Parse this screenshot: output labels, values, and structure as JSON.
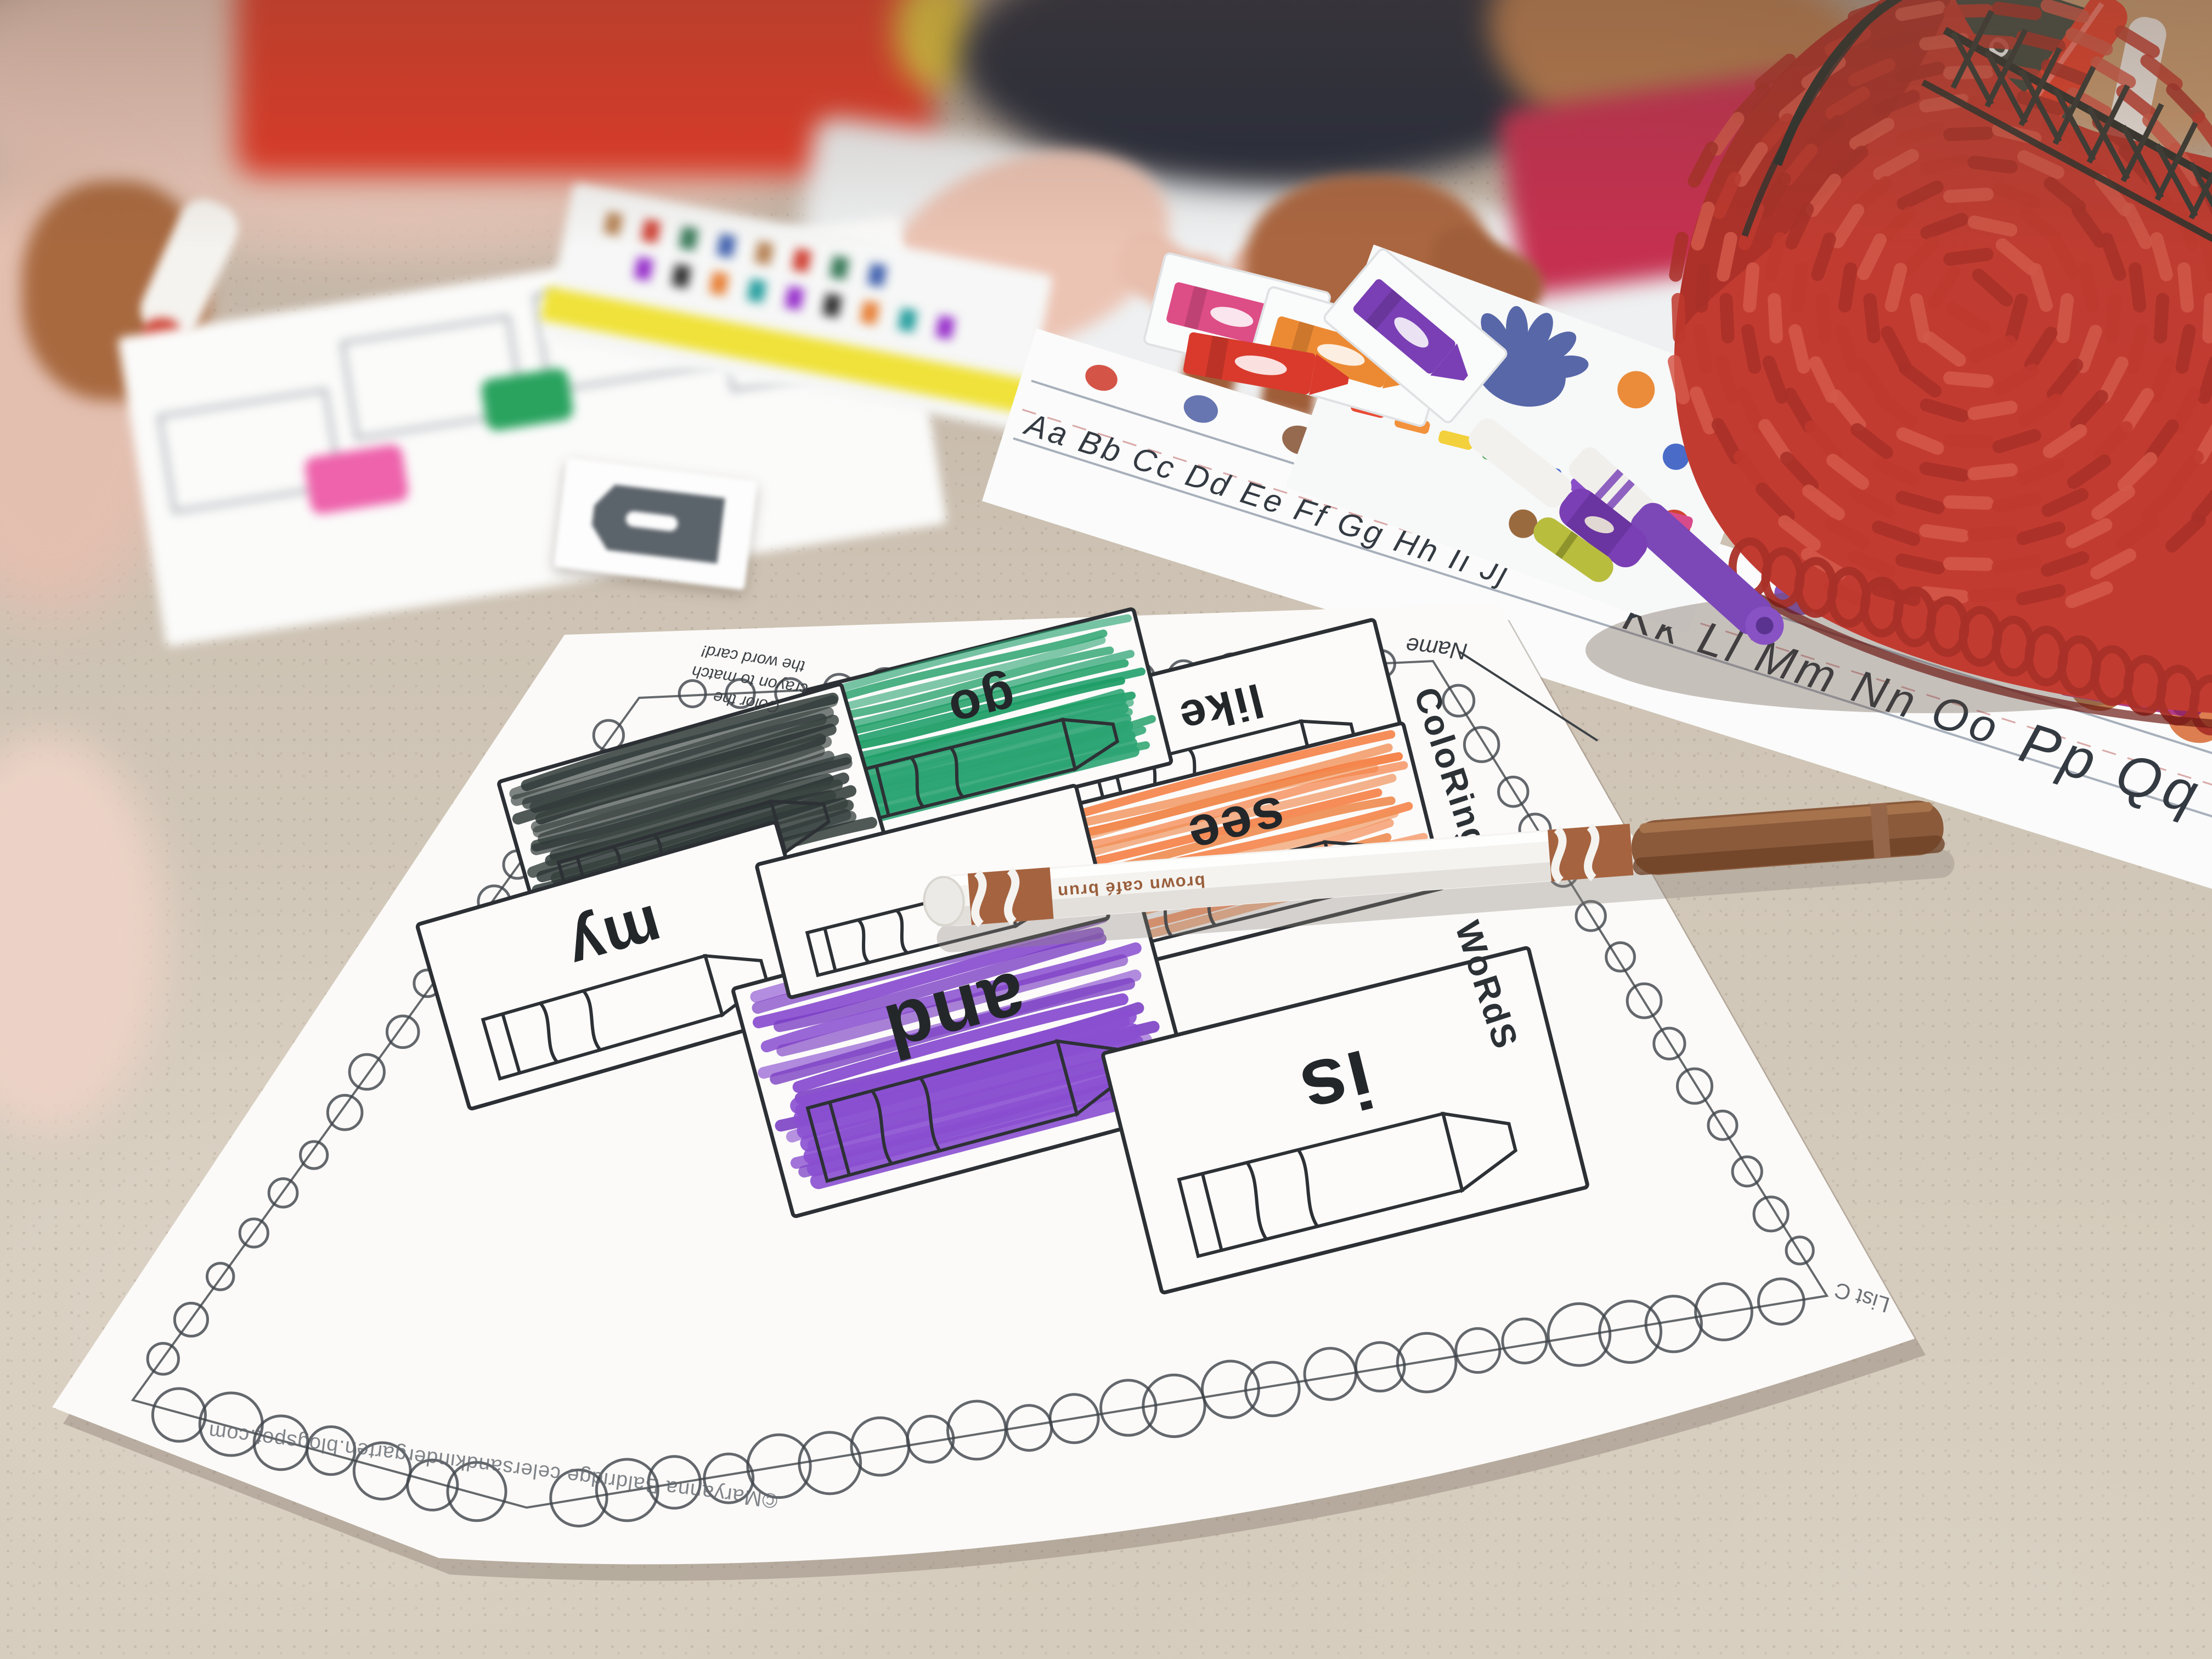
{
  "scene": {
    "description": "Kindergarten classroom table, top-down oblique photo: sight-word coloring worksheet with Crayola markers, word cards, alphabet strip and red woven apple basket; children's hands reaching across",
    "table_color": "#cdc2b3"
  },
  "worksheet": {
    "name_label": "Name",
    "title_segment_1": "ColoRing",
    "title_segment_2": "WoRdS",
    "instruction_lines": [
      "Color the",
      "crayon to match",
      "the word card!"
    ],
    "footer_credit": "©Maryanna Baldridge  celersandkindergarten.blogspot.com",
    "list_label": "List C",
    "word_boxes": [
      {
        "word": "like",
        "scribble": "none"
      },
      {
        "word": "go",
        "scribble": "green"
      },
      {
        "word": "see",
        "scribble": "orange"
      },
      {
        "word": "",
        "scribble": "black",
        "note": "word hidden under black scribble"
      },
      {
        "word": "my",
        "scribble": "none"
      },
      {
        "word": "and",
        "scribble": "purple"
      },
      {
        "word": "is",
        "scribble": "none"
      },
      {
        "word": "",
        "scribble": "none",
        "note": "box mostly hidden under brown marker"
      }
    ],
    "scribble_colors": {
      "green": "#2ca473",
      "orange": "#f4793b",
      "black": "#37413e",
      "purple": "#8a4fd0"
    }
  },
  "brown_marker": {
    "label": "brown café brun",
    "barrel_color": "#f4f3f0",
    "band_color": "#a5633f",
    "cap_color": "#8a5a3b"
  },
  "alphabet_strip": {
    "segments": [
      "Aa Bb Cc Dd Ee Ff Gg Hh Ii Jj",
      "Kk Ll Mm Nn Oo",
      "Pp Qq Rr"
    ]
  },
  "basket": {
    "description": "red woven apple basket with dark wire rim, holding a Crayola marker box and markers",
    "body_color": "#c23b31",
    "weave_shadow": "#a93028",
    "weave_highlight": "#d4594a",
    "rim_wire_color": "#2c322e",
    "box_label_fragment": "olo"
  },
  "word_cards": [
    {
      "color_name": "pink",
      "hex": "#dd4d86"
    },
    {
      "color_name": "orange",
      "hex": "#ec8a33"
    },
    {
      "color_name": "purple",
      "hex": "#7a3fb4"
    },
    {
      "color_name": "red",
      "hex": "#d93a2c"
    },
    {
      "color_name": "black",
      "hex": "#5c646b"
    }
  ],
  "other_markers": [
    {
      "name": "purple-marker-uncapped",
      "hex": "#7c48b8"
    },
    {
      "name": "purple-marker-capped",
      "hex": "#7a3fb4"
    },
    {
      "name": "yellow-green-marker",
      "hex": "#b9bd3e"
    },
    {
      "name": "pink-marker",
      "hex": "#e8459b"
    },
    {
      "name": "black-marker",
      "hex": "#4a4f52"
    },
    {
      "name": "red-marker-cap",
      "hex": "#dd3a2c"
    },
    {
      "name": "magenta-marker",
      "hex": "#b23c86"
    },
    {
      "name": "white-marker-held",
      "hex": "#f5f3ef"
    }
  ],
  "second_worksheet": {
    "colored_boxes": [
      "pink",
      "green"
    ],
    "pink_hex": "#ee63ac",
    "green_hex": "#2aa35f"
  }
}
